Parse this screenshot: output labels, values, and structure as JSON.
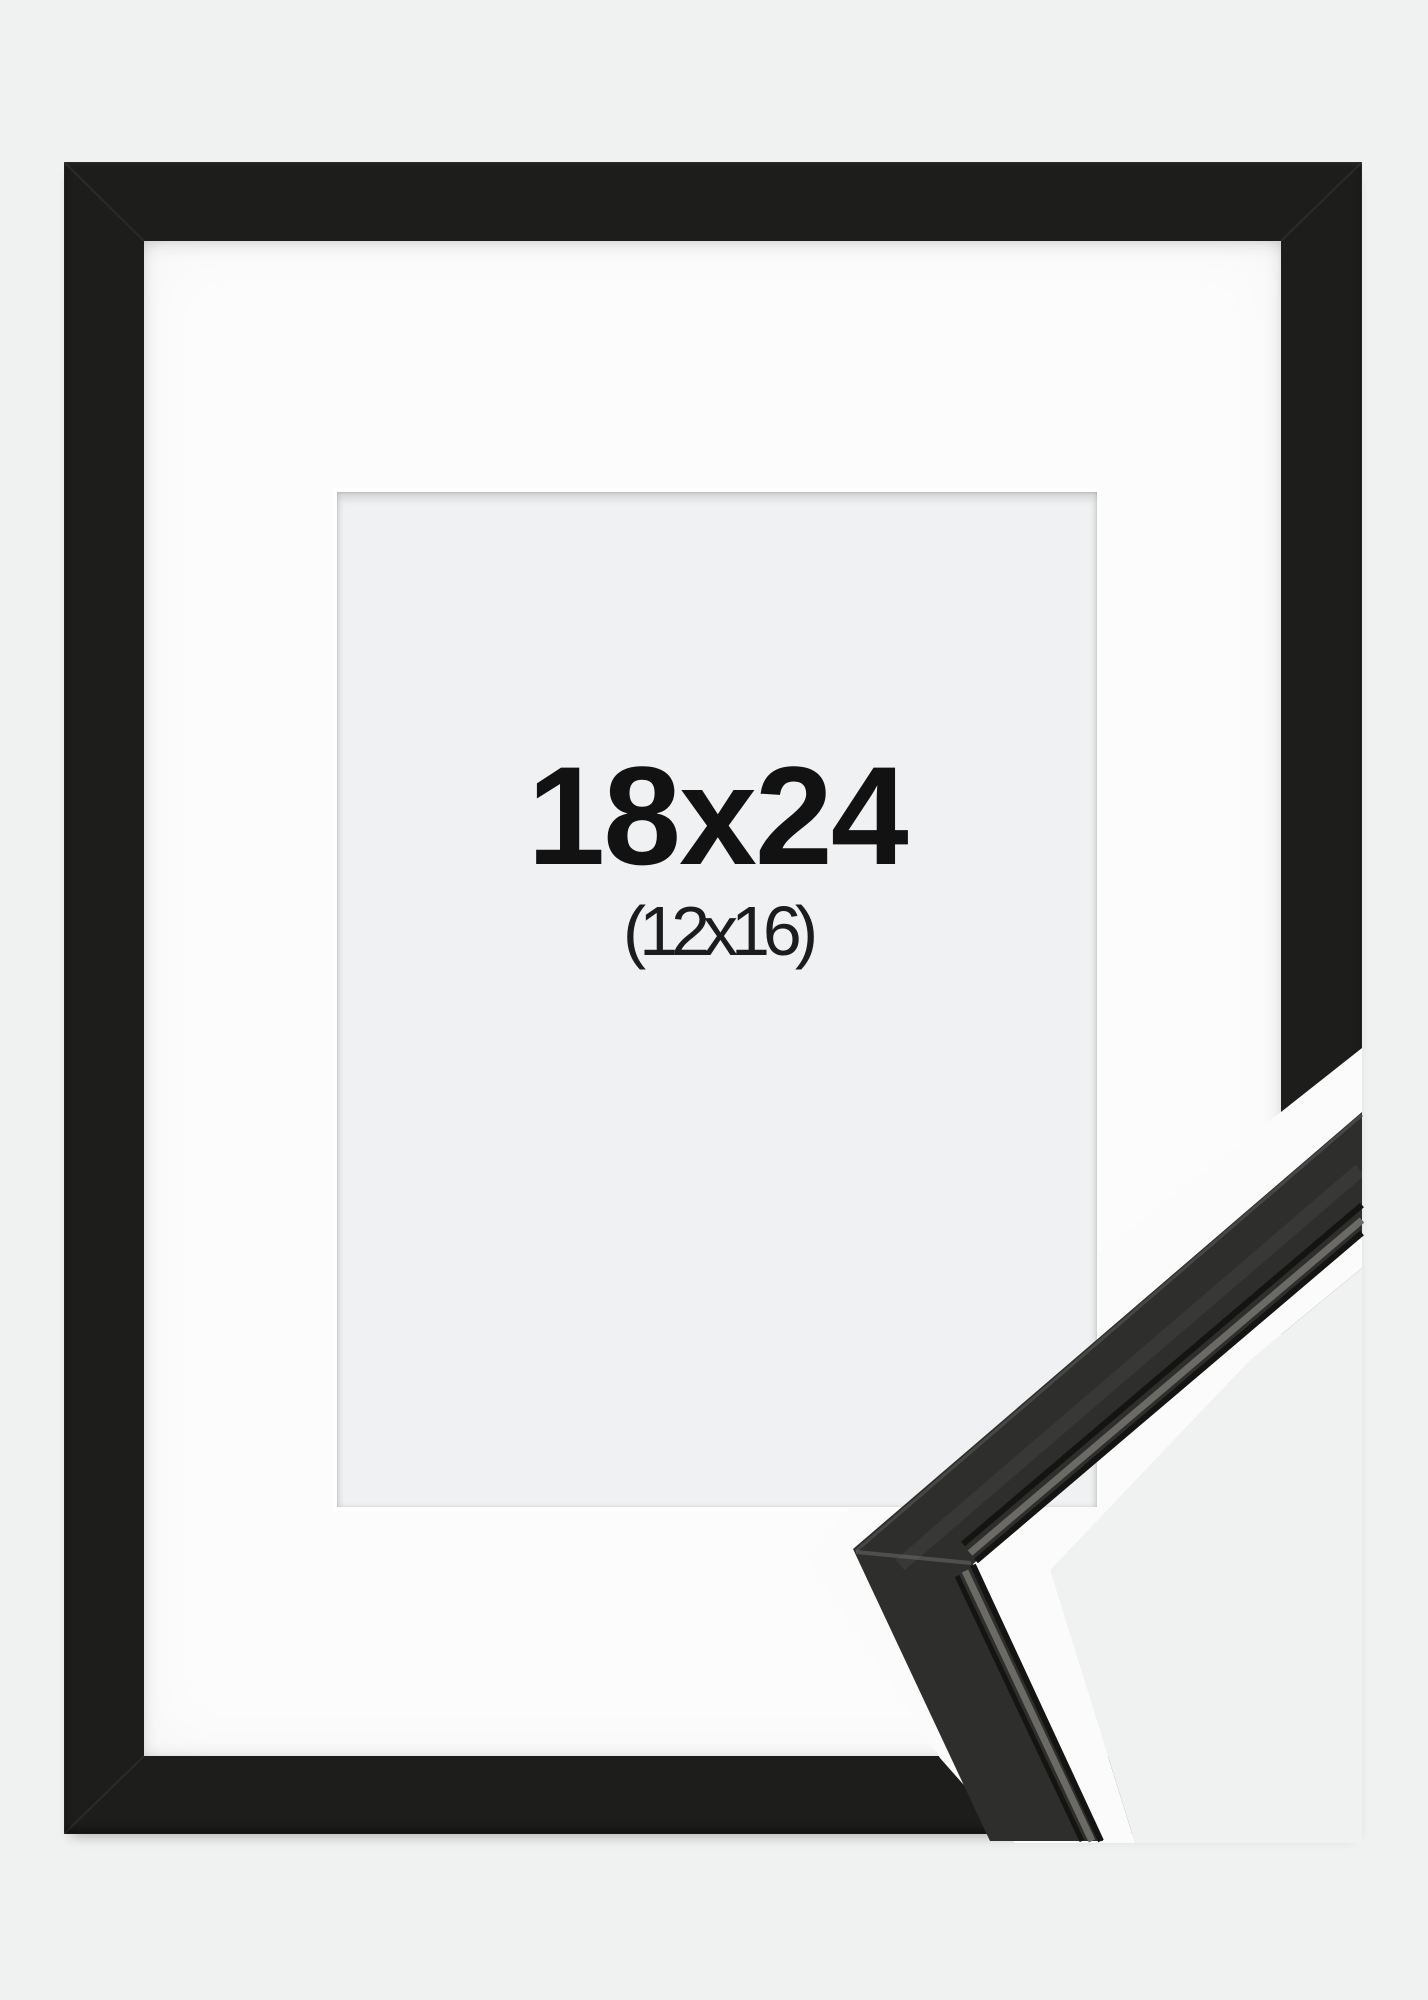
{
  "product": {
    "size_label": "18x24",
    "matted_size_label": "(12x16)",
    "frame_style": "black-frame-with-white-mat"
  },
  "colors": {
    "background": "#f0f1f1",
    "frame": "#1d1d1b",
    "mat": "#fcfcfd",
    "window": "#f0f1f2",
    "text": "#121212",
    "glow": "#fbfbfb",
    "moulding": "#2e2e2c",
    "moulding_dark": "#141412",
    "moulding_mid": "#6b6a64",
    "moulding_highlight": "#4c4c4a",
    "backdrop": "#f0f1f1"
  }
}
